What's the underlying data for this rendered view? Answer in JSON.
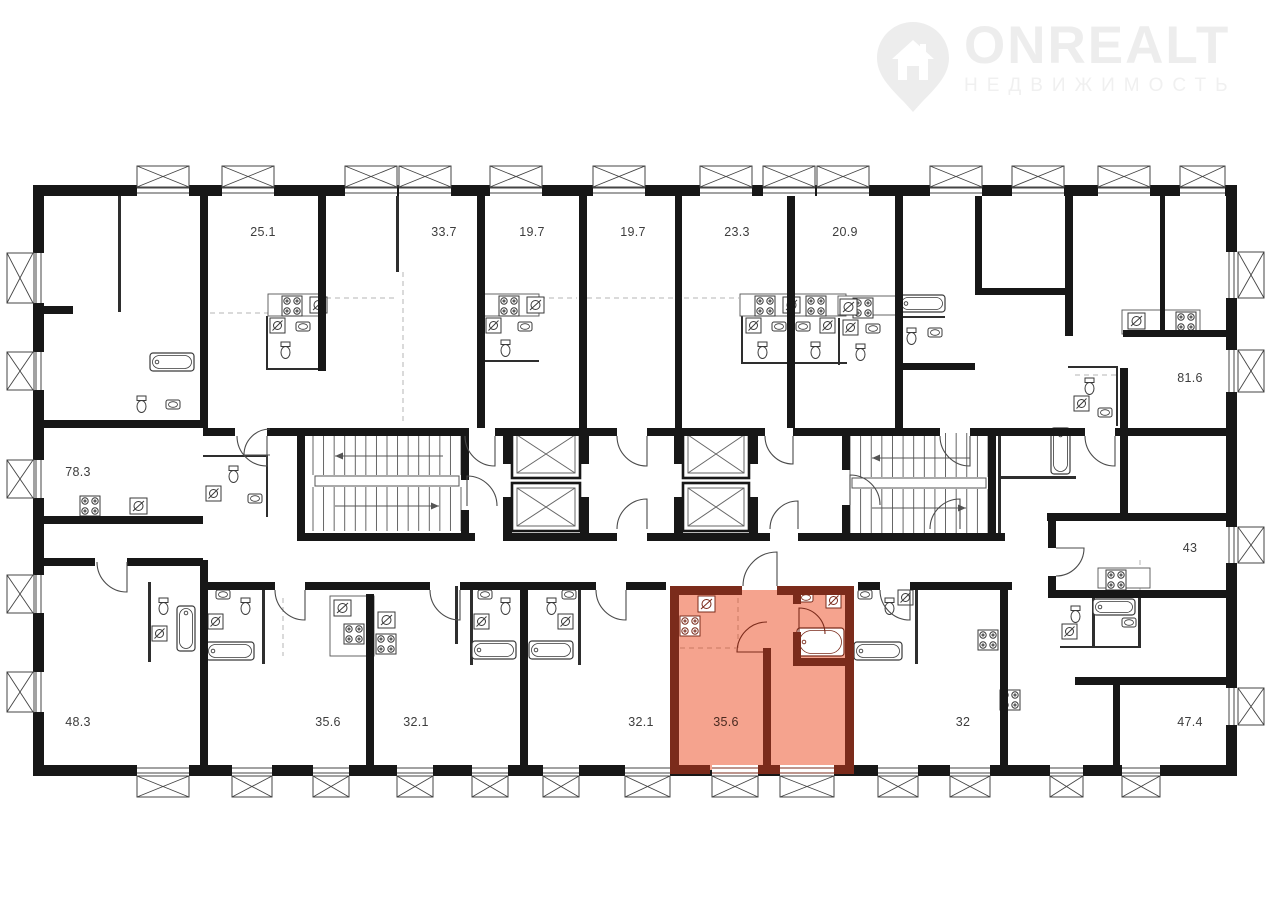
{
  "brand": {
    "name": "ONREALT",
    "subtitle": "НЕДВИЖИМОСТЬ"
  },
  "floorplan": {
    "highlighted_area": "35.6",
    "colors": {
      "wall": "#171717",
      "highlight_fill": "#f5a38e",
      "highlight_wall": "#7b2b1b"
    },
    "rooms": [
      {
        "area": "25.1",
        "highlighted": false
      },
      {
        "area": "33.7",
        "highlighted": false
      },
      {
        "area": "19.7",
        "highlighted": false
      },
      {
        "area": "19.7",
        "highlighted": false
      },
      {
        "area": "23.3",
        "highlighted": false
      },
      {
        "area": "20.9",
        "highlighted": false
      },
      {
        "area": "81.6",
        "highlighted": false
      },
      {
        "area": "78.3",
        "highlighted": false
      },
      {
        "area": "43",
        "highlighted": false
      },
      {
        "area": "48.3",
        "highlighted": false
      },
      {
        "area": "35.6",
        "highlighted": false
      },
      {
        "area": "32.1",
        "highlighted": false
      },
      {
        "area": "32.1",
        "highlighted": false
      },
      {
        "area": "35.6",
        "highlighted": true
      },
      {
        "area": "32",
        "highlighted": false
      },
      {
        "area": "47.4",
        "highlighted": false
      }
    ]
  }
}
